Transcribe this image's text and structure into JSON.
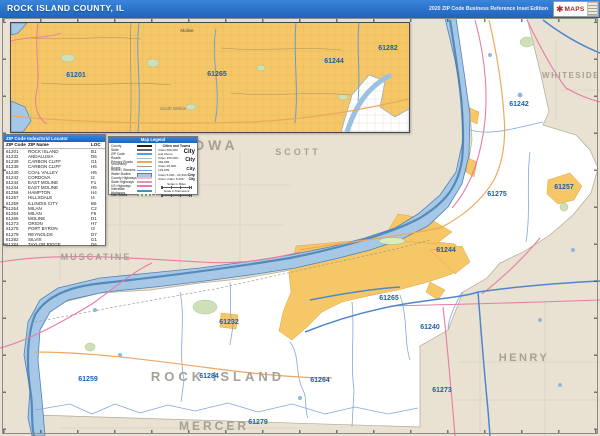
{
  "header": {
    "title": "ROCK ISLAND COUNTY, IL",
    "edition": "2020 ZIP Code Business Reference Inset Edition",
    "logo_text": "MAPS"
  },
  "zip_table": {
    "title": "ZIP Code Index/Grid Locator",
    "columns": [
      "ZIP Code",
      "ZIP Name",
      "LOC"
    ],
    "rows": [
      [
        "61201",
        "ROCK ISLAND",
        "B1"
      ],
      [
        "61232",
        "ANDALUSIA",
        "D6"
      ],
      [
        "61239",
        "CARBON CLIFF",
        "G1"
      ],
      [
        "61239",
        "CARBON CLIFF",
        "H5"
      ],
      [
        "61240",
        "COAL VALLEY",
        "H5"
      ],
      [
        "61242",
        "CORDOVA",
        "I2"
      ],
      [
        "61244",
        "EAST MOLINE",
        "F1"
      ],
      [
        "61244",
        "EAST MOLINE",
        "H5"
      ],
      [
        "61256",
        "HAMPTON",
        "H4"
      ],
      [
        "61257",
        "HILLSDALE",
        "I4"
      ],
      [
        "61259",
        "ILLINOIS CITY",
        "B6"
      ],
      [
        "61264",
        "MILAN",
        "C2"
      ],
      [
        "61264",
        "MILAN",
        "F6"
      ],
      [
        "61265",
        "MOLINE",
        "D1"
      ],
      [
        "61273",
        "ORION",
        "H7"
      ],
      [
        "61275",
        "PORT BYRON",
        "I3"
      ],
      [
        "61279",
        "REYNOLDS",
        "D7"
      ],
      [
        "61282",
        "SILVIS",
        "G1"
      ],
      [
        "61284",
        "TAYLOR RIDGE",
        "D6"
      ]
    ]
  },
  "legend": {
    "title": "Map Legend",
    "line_items": [
      {
        "label": "County"
      },
      {
        "label": "State"
      },
      {
        "label": "ZIP Code"
      },
      {
        "label": "Roads"
      },
      {
        "label": "Primary Roads"
      },
      {
        "label": "Secondary Roads"
      },
      {
        "label": "Rivers / Streams"
      },
      {
        "label": "Water Bodies"
      },
      {
        "label": "County Highways"
      },
      {
        "label": "State Highways"
      },
      {
        "label": "US Highways"
      },
      {
        "label": "Interstate Highways"
      },
      {
        "label": "Rail Roads"
      }
    ],
    "cities_header": "Cities and Towns",
    "city_classes": [
      {
        "label": "Cities 500,000 and Above",
        "sample": "City"
      },
      {
        "label": "Cities 150,000 - 499,999",
        "sample": "City"
      },
      {
        "label": "Cities 25,000 - 149,999",
        "sample": "City"
      },
      {
        "label": "Cities 5,000 - 24,999",
        "sample": "City"
      },
      {
        "label": "Cities Under 5,000",
        "sample": "City"
      }
    ],
    "scale_miles_label": "Scale in Miles",
    "scale_km_label": "Scale in Kilometers"
  },
  "map": {
    "state_label": "IOWA",
    "county_labels": [
      {
        "text": "SCOTT"
      },
      {
        "text": "WHITESIDE"
      },
      {
        "text": "MUSCATINE"
      },
      {
        "text": "ROCK ISLAND"
      },
      {
        "text": "MERCER"
      },
      {
        "text": "HENRY"
      }
    ],
    "zip_labels": [
      {
        "text": "61242"
      },
      {
        "text": "61257"
      },
      {
        "text": "61275"
      },
      {
        "text": "61244"
      },
      {
        "text": "61265"
      },
      {
        "text": "61240"
      },
      {
        "text": "61264"
      },
      {
        "text": "61273"
      },
      {
        "text": "61279"
      },
      {
        "text": "61284"
      },
      {
        "text": "61232"
      },
      {
        "text": "61259"
      }
    ],
    "inset": {
      "zip_labels": [
        {
          "text": "61201"
        },
        {
          "text": "61265"
        },
        {
          "text": "61244"
        },
        {
          "text": "61282"
        }
      ],
      "city_labels": [
        {
          "text": "Moline"
        },
        {
          "text": "South Moline"
        }
      ]
    }
  },
  "colors": {
    "header_blue": "#2573cd",
    "out_of_county_beige": "#e9e1d1",
    "county_white": "#ffffff",
    "urban_yellow": "#f6c766",
    "river_blue": "#a6c8e6",
    "zip_label_blue": "#1d5cb0",
    "county_label_gray": "#a5a196",
    "pink_road": "#e87ca3",
    "orange_road": "#eda75d",
    "highway_blue": "#4f86cf"
  }
}
